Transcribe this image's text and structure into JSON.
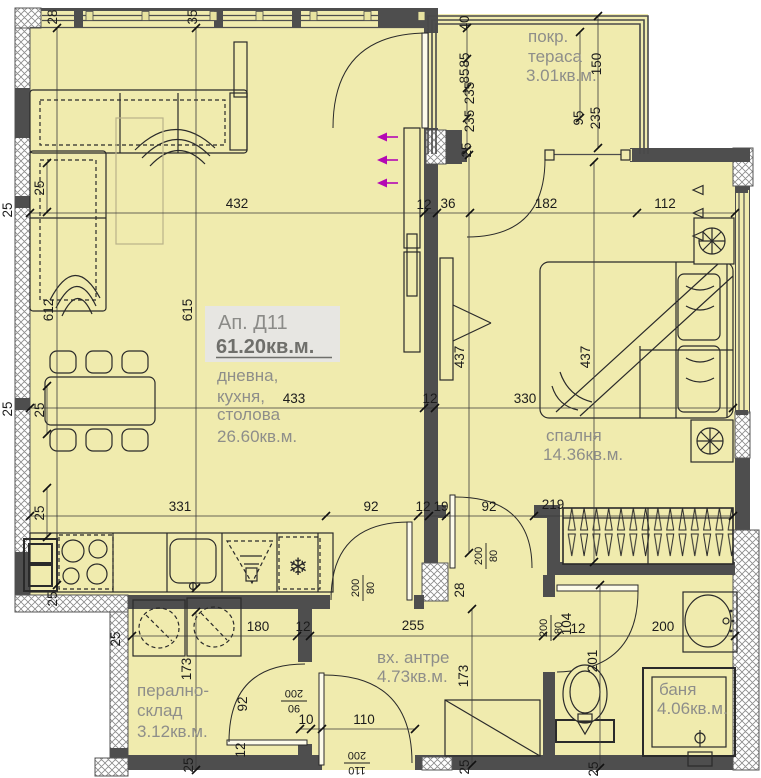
{
  "plan": {
    "unit": {
      "name": "Ап. Д11",
      "area": "61.20кв.м."
    },
    "rooms": [
      {
        "name": "покр. тераса",
        "area": "3.01кв.м."
      },
      {
        "name": "дневна, кухня, столова",
        "area": "26.60кв.м."
      },
      {
        "name": "спалня",
        "area": "14.36кв.м."
      },
      {
        "name": "вх. антре",
        "area": "4.73кв.м."
      },
      {
        "name": "перално-склад",
        "area": "3.12кв.м."
      },
      {
        "name": "баня",
        "area": "4.06кв.м."
      }
    ],
    "room_labels": [
      {
        "t": "покр.",
        "x": 528,
        "y": 42
      },
      {
        "t": "тераса",
        "x": 528,
        "y": 62
      },
      {
        "t": "3.01кв.м.",
        "x": 526,
        "y": 81
      },
      {
        "t": "дневна,",
        "x": 217,
        "y": 381
      },
      {
        "t": "кухня,",
        "x": 217,
        "y": 402
      },
      {
        "t": "столова",
        "x": 217,
        "y": 420
      },
      {
        "t": "26.60кв.м.",
        "x": 217,
        "y": 442
      },
      {
        "t": "спалня",
        "x": 546,
        "y": 441
      },
      {
        "t": "14.36кв.м.",
        "x": 543,
        "y": 460
      },
      {
        "t": "вх. антре",
        "x": 377,
        "y": 663
      },
      {
        "t": "4.73кв.м.",
        "x": 377,
        "y": 682
      },
      {
        "t": "перално-",
        "x": 137,
        "y": 696
      },
      {
        "t": "склад",
        "x": 137,
        "y": 716
      },
      {
        "t": "3.12кв.м.",
        "x": 137,
        "y": 737
      },
      {
        "t": "баня",
        "x": 659,
        "y": 695
      },
      {
        "t": "4.06кв.м.",
        "x": 657,
        "y": 714
      }
    ],
    "dimensions": [
      {
        "t": "432",
        "x": 237,
        "y": 208
      },
      {
        "t": "12",
        "x": 424,
        "y": 209,
        "s": 11
      },
      {
        "t": "36",
        "x": 448,
        "y": 208
      },
      {
        "t": "182",
        "x": 546,
        "y": 208
      },
      {
        "t": "112",
        "x": 665,
        "y": 208
      },
      {
        "t": "433",
        "x": 294,
        "y": 403
      },
      {
        "t": "12",
        "x": 430,
        "y": 403,
        "s": 11
      },
      {
        "t": "330",
        "x": 525,
        "y": 403
      },
      {
        "t": "331",
        "x": 180,
        "y": 511
      },
      {
        "t": "92",
        "x": 371,
        "y": 511
      },
      {
        "t": "12",
        "x": 423,
        "y": 511,
        "s": 11
      },
      {
        "t": "19",
        "x": 441,
        "y": 511,
        "s": 11
      },
      {
        "t": "92",
        "x": 489,
        "y": 511
      },
      {
        "t": "219",
        "x": 553,
        "y": 509
      },
      {
        "t": "180",
        "x": 258,
        "y": 631
      },
      {
        "t": "12",
        "x": 303,
        "y": 631,
        "s": 11
      },
      {
        "t": "255",
        "x": 413,
        "y": 630
      },
      {
        "t": "12",
        "x": 578,
        "y": 633,
        "s": 11
      },
      {
        "t": "200",
        "x": 663,
        "y": 631
      },
      {
        "t": "10",
        "x": 306,
        "y": 724
      },
      {
        "t": "110",
        "x": 364,
        "y": 724
      },
      {
        "t": "28",
        "x": 57,
        "y": 17,
        "r": -90
      },
      {
        "t": "35",
        "x": 197,
        "y": 17,
        "r": -90
      },
      {
        "t": "40",
        "x": 469,
        "y": 23,
        "r": -90
      },
      {
        "t": "85",
        "x": 469,
        "y": 60,
        "r": -90
      },
      {
        "t": "85",
        "x": 469,
        "y": 76,
        "r": -90
      },
      {
        "t": "235",
        "x": 474,
        "y": 93,
        "r": -90
      },
      {
        "t": "235",
        "x": 474,
        "y": 121,
        "r": -90
      },
      {
        "t": "25",
        "x": 471,
        "y": 150,
        "r": -90
      },
      {
        "t": "150",
        "x": 601,
        "y": 64,
        "r": -90
      },
      {
        "t": "95",
        "x": 583,
        "y": 118,
        "r": -90
      },
      {
        "t": "235",
        "x": 600,
        "y": 118,
        "r": -90
      },
      {
        "t": "612",
        "x": 53,
        "y": 310,
        "r": -90
      },
      {
        "t": "615",
        "x": 192,
        "y": 310,
        "r": -90
      },
      {
        "t": "25",
        "x": 12,
        "y": 210,
        "r": -90
      },
      {
        "t": "25",
        "x": 12,
        "y": 409,
        "r": -90
      },
      {
        "t": "25",
        "x": 44,
        "y": 188,
        "r": -90
      },
      {
        "t": "25",
        "x": 44,
        "y": 410,
        "r": -90
      },
      {
        "t": "25",
        "x": 44,
        "y": 513,
        "r": -90
      },
      {
        "t": "437",
        "x": 464,
        "y": 357,
        "r": -90
      },
      {
        "t": "437",
        "x": 590,
        "y": 357,
        "r": -90
      },
      {
        "t": "25",
        "x": 57,
        "y": 599,
        "r": -90
      },
      {
        "t": "25",
        "x": 120,
        "y": 639,
        "r": -90
      },
      {
        "t": "173",
        "x": 191,
        "y": 669,
        "r": -90
      },
      {
        "t": "92",
        "x": 247,
        "y": 704,
        "r": -90
      },
      {
        "t": "12",
        "x": 245,
        "y": 750,
        "r": -90
      },
      {
        "t": "173",
        "x": 468,
        "y": 676,
        "r": -90
      },
      {
        "t": "28",
        "x": 464,
        "y": 590,
        "r": -90
      },
      {
        "t": "104",
        "x": 571,
        "y": 624,
        "r": -90
      },
      {
        "t": "201",
        "x": 597,
        "y": 661,
        "r": -90
      },
      {
        "t": "25",
        "x": 193,
        "y": 765,
        "r": -90
      },
      {
        "t": "25",
        "x": 469,
        "y": 767,
        "r": -90
      },
      {
        "t": "25",
        "x": 598,
        "y": 769,
        "r": -90
      }
    ],
    "door_markings": [
      {
        "a": "200",
        "b": "80",
        "x": 363,
        "y": 588,
        "r": -90
      },
      {
        "a": "200",
        "b": "80",
        "x": 486,
        "y": 556,
        "r": -90
      },
      {
        "a": "200",
        "b": "80",
        "x": 551,
        "y": 628,
        "r": -90
      },
      {
        "a": "90",
        "b": "200",
        "x": 294,
        "y": 701,
        "r": 180
      },
      {
        "a": "110",
        "b": "200",
        "x": 357,
        "y": 763,
        "r": 180
      }
    ],
    "colors": {
      "floor": "#f0ebae",
      "wall": "#4e4e4e",
      "dim_text": "#1c1c1c",
      "label_text": "#8e8e8a",
      "accent_arrows": "#b408b4",
      "title_bg": "#e7e6e2",
      "title_text": "#8b8b88",
      "area_text": "#6f6f6b"
    }
  }
}
